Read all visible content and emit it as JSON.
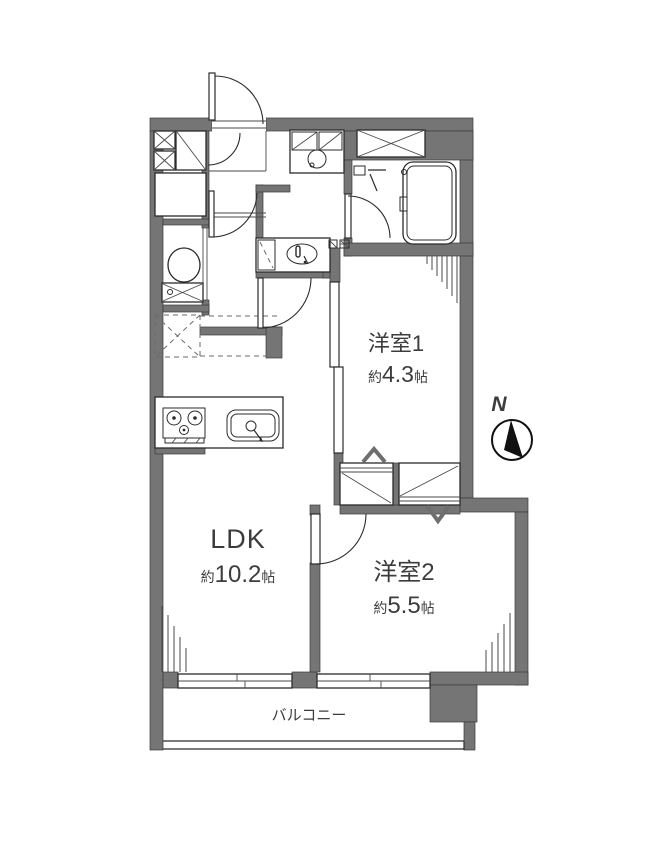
{
  "floor_plan": {
    "rooms": {
      "yoshitsu1": {
        "name": "洋室1",
        "size_prefix": "約",
        "size_value": "4.3",
        "size_unit": "帖"
      },
      "yoshitsu2": {
        "name": "洋室2",
        "size_prefix": "約",
        "size_value": "5.5",
        "size_unit": "帖"
      },
      "ldk": {
        "name": "LDK",
        "size_prefix": "約",
        "size_value": "10.2",
        "size_unit": "帖"
      },
      "balcony": {
        "name": "バルコニー"
      }
    },
    "compass": {
      "north_label": "N"
    },
    "colors": {
      "wall": "#757575",
      "line": "#2b2b2b",
      "text": "#3c3c3c",
      "background": "#ffffff"
    }
  }
}
